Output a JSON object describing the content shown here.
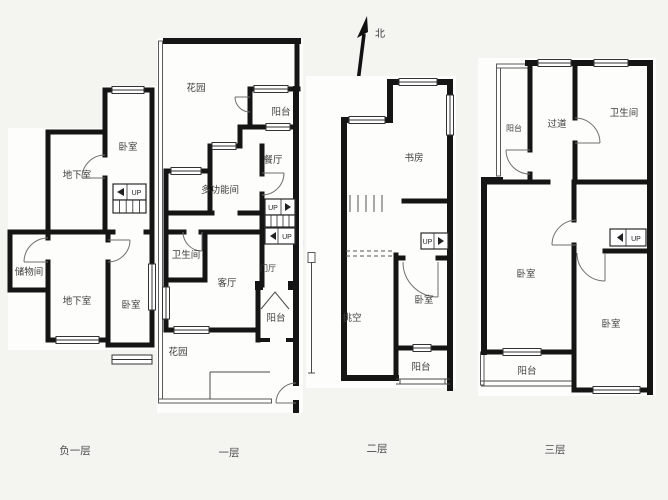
{
  "north": {
    "label": "北"
  },
  "colors": {
    "wall": "#151515",
    "thin_line": "#555555",
    "text": "#3d3d3d",
    "background": "#f4f4f1"
  },
  "floors": [
    {
      "caption": "负一层",
      "rooms": {
        "bedroom_top": "卧室",
        "basement_upper": "地下室",
        "storage": "储物间",
        "basement_lower": "地下室",
        "bedroom_lower": "卧室"
      },
      "stairs": {
        "up1": "UP"
      }
    },
    {
      "caption": "一层",
      "rooms": {
        "garden_top": "花园",
        "balcony_top": "阳台",
        "dining": "餐厅",
        "multi_function": "多功能间",
        "bathroom": "卫生间",
        "living": "客厅",
        "foyer": "门厅",
        "balcony_bottom": "阳台",
        "garden_bottom": "花园"
      },
      "stairs": {
        "up1": "UP",
        "up2": "UP"
      }
    },
    {
      "caption": "二层",
      "rooms": {
        "study": "书房",
        "void": "挑空",
        "bedroom": "卧室",
        "balcony": "阳台"
      },
      "stairs": {
        "up1": "UP"
      }
    },
    {
      "caption": "三层",
      "rooms": {
        "balcony_top": "阳台",
        "corridor": "过道",
        "bathroom": "卫生间",
        "bedroom_left": "卧室",
        "bedroom_right": "卧室",
        "balcony_bottom": "阳台"
      },
      "stairs": {
        "up1": "UP"
      }
    }
  ]
}
